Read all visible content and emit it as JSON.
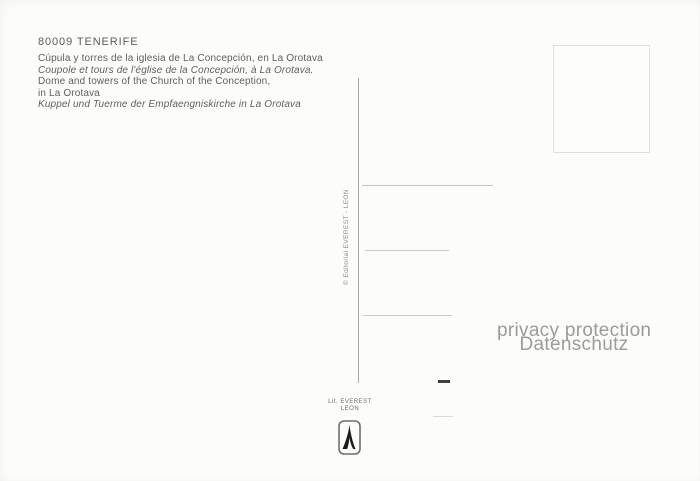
{
  "postcard": {
    "catalog_number": "80009 TENERIFE",
    "captions": [
      {
        "lang": "es",
        "text": "Cúpula y torres de la iglesia de La Concepción, en La Orotava"
      },
      {
        "lang": "fr",
        "text": "Coupole et tours de l'église de la Concepción, à La Orotava."
      },
      {
        "lang": "en",
        "text": "Dome and towers of the Church of the Conception,"
      },
      {
        "lang": "en",
        "text": "in La Orotava"
      },
      {
        "lang": "de",
        "text": "Kuppel und Tuerme der Empfaengniskirche in La Orotava"
      }
    ],
    "publisher_vertical": "© Editorial EVEREST - LEON",
    "printer": {
      "line1": "Lit. EVEREST",
      "line2": "LEON"
    },
    "watermark": {
      "line1": "privacy protection",
      "line2": "Datenschutz"
    }
  },
  "colors": {
    "background": "#fcfcfa",
    "text": "#5f5f5d",
    "divider": "#a6a6a3",
    "address_line": "#cbcbc8",
    "stamp_border": "#e0e0dd",
    "watermark": "#9b9b99",
    "dash_dark": "#3f3f3d"
  }
}
